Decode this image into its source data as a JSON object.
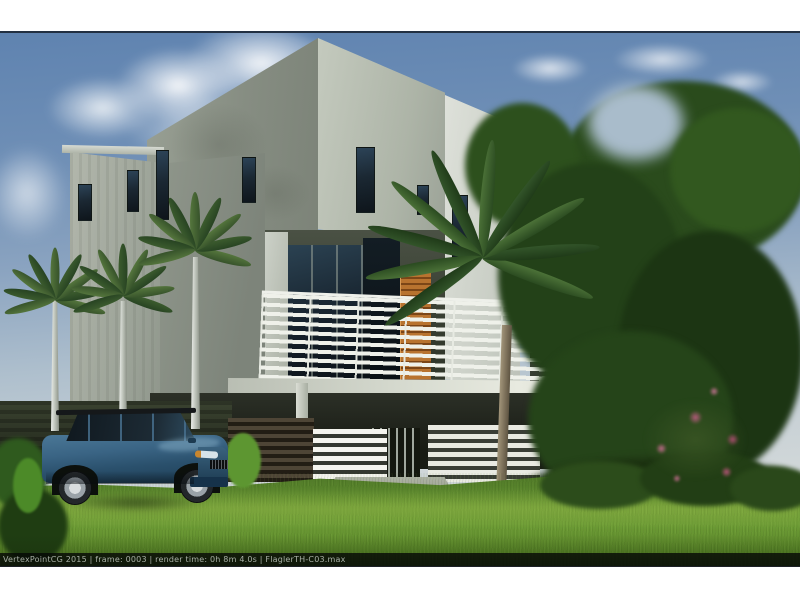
{
  "photo": {
    "type": "architectural-rendering",
    "subject": "Modern three-story townhouse rendering with royal palms, tropical tree, slat fences and a blue SUV parked on the lawn",
    "watermark": "VertexPointCG 2015 | frame: 0003 | render time: 0h 8m 4.0s | FlaglerTH-C03.max"
  },
  "colors": {
    "sky_top": "#5f83b0",
    "sky_horizon": "#d8dcda",
    "stucco_light": "#c4cabe",
    "stucco_mid": "#969d91",
    "stucco_dark": "#7d847a",
    "wood_accent": "#b8732f",
    "railing_white": "#eff1ea",
    "window_glass": "#1b2833",
    "foliage_dark": "#1c3513",
    "palm_frond": "#4c7238",
    "grass": "#6d9c36",
    "flower_pink": "#c06b8a",
    "suv_blue": "#3a6484",
    "watermark_text": "#a8b0a6"
  }
}
